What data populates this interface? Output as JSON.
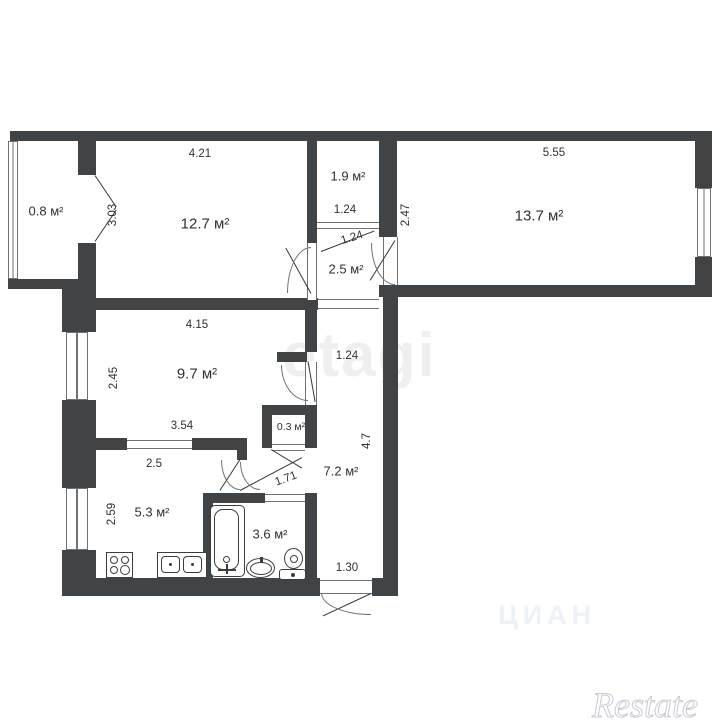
{
  "rooms": {
    "balcony": "0.8 м²",
    "living": "12.7 м²",
    "wardrobe": "1.9 м²",
    "bedroom": "13.7 м²",
    "hall": "2.5 м²",
    "room": "9.7 м²",
    "closet": "0.3 м²",
    "corridor": "7.2 м²",
    "kitchen": "5.3 м²",
    "bathroom": "3.6 м²"
  },
  "dims": {
    "living_w": "4.21",
    "living_h": "3.03",
    "wardrobe_w": "1.24",
    "wardrobe_door": "1.24",
    "bedroom_w": "5.55",
    "bedroom_h": "2.47",
    "room_w": "4.15",
    "room_h": "2.45",
    "room_w2": "3.54",
    "corridor_w": "1.24",
    "corridor_h": "4.7",
    "bath_door": "1.71",
    "kitchen_w": "2.5",
    "kitchen_h": "2.59",
    "entrance_w": "1.30"
  },
  "watermarks": {
    "center": "etagi",
    "bottom": "ЦИАН",
    "corner": "Restate"
  },
  "colors": {
    "wall": "#404447",
    "line": "#6f7275",
    "text": "#2e3134",
    "bg": "#ffffff"
  }
}
